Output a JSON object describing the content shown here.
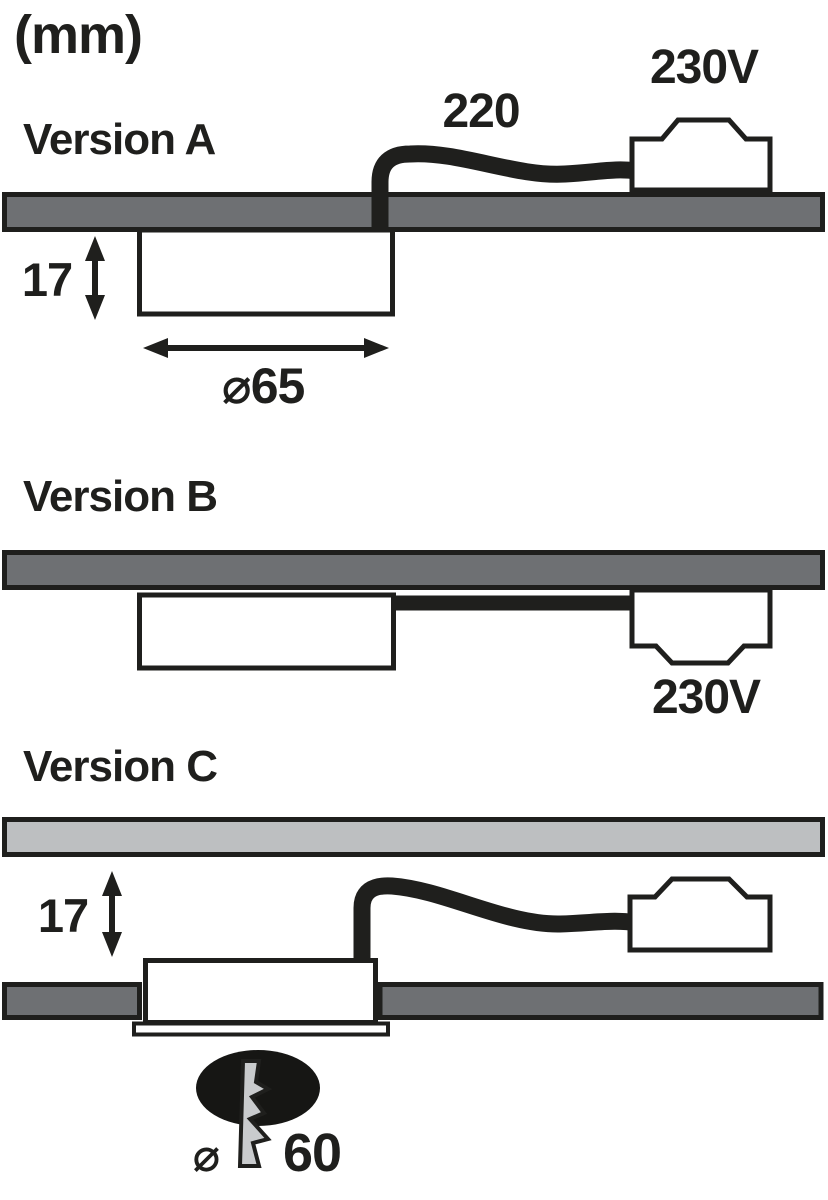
{
  "diagram_title": "Luminaire installation dimensions",
  "unit_label": "(mm)",
  "colors": {
    "outline": "#1f1f1d",
    "cable_black": "#1f1f1d",
    "panel_dark": "#6e7073",
    "panel_light": "#bdbfc1",
    "housing_white": "#ffffff",
    "drill_bit_gray": "#c9cbcd",
    "hole_black": "#161614"
  },
  "version_a": {
    "title": "Version A",
    "cable_length_label": "220",
    "voltage_label": "230V",
    "depth_label": "17",
    "diameter_label": "⌀65"
  },
  "version_b": {
    "title": "Version B",
    "voltage_label": "230V"
  },
  "version_c": {
    "title": "Version C",
    "clearance_label": "17",
    "drill_diameter_symbol": "⌀",
    "drill_diameter_value": "60"
  },
  "icons": {
    "drill_hole": "filled-ellipse",
    "drill_bit": "lightning-bolt-zigzag"
  }
}
